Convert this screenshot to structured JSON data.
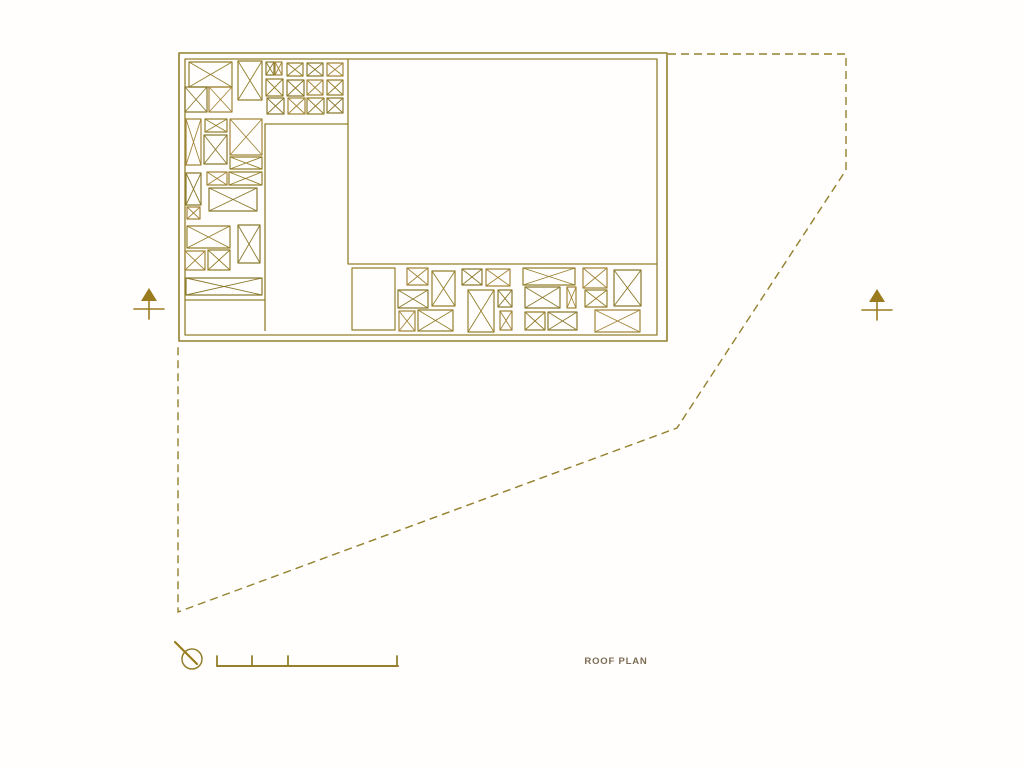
{
  "canvas": {
    "width": 1024,
    "height": 768,
    "background": "#fffefc"
  },
  "title": {
    "label": "ROOF PLAN",
    "color": "#7c6c55"
  },
  "ink": {
    "primary": "#94802d",
    "palette": [
      "#94802d",
      "#8b7a2e",
      "#a3863a"
    ],
    "arrow": "#9a7c1e",
    "dash": "8 5"
  },
  "plan": {
    "outer_wall": [
      179,
      53,
      488,
      288
    ],
    "inner_wall": [
      185,
      59,
      472,
      276
    ],
    "partitions": [
      [
        [
          348,
          59
        ],
        [
          348,
          264
        ],
        [
          657,
          264
        ]
      ],
      [
        [
          348,
          124
        ],
        [
          265,
          124
        ],
        [
          265,
          331
        ]
      ],
      [
        [
          185,
          300
        ],
        [
          265,
          300
        ]
      ]
    ],
    "plain_boxes": [
      [
        352,
        268,
        43,
        62
      ]
    ],
    "crossed_boxes": [
      [
        189,
        62,
        43,
        25
      ],
      [
        185,
        87,
        22,
        25
      ],
      [
        209,
        87,
        23,
        25
      ],
      [
        238,
        61,
        24,
        39
      ],
      [
        266,
        62,
        8,
        13
      ],
      [
        275,
        62,
        7,
        13
      ],
      [
        287,
        63,
        16,
        13
      ],
      [
        307,
        63,
        16,
        13
      ],
      [
        327,
        63,
        16,
        13
      ],
      [
        266,
        79,
        17,
        17
      ],
      [
        287,
        80,
        17,
        16
      ],
      [
        307,
        80,
        16,
        15
      ],
      [
        327,
        80,
        16,
        15
      ],
      [
        267,
        98,
        17,
        16
      ],
      [
        288,
        98,
        17,
        16
      ],
      [
        307,
        98,
        17,
        16
      ],
      [
        327,
        98,
        16,
        15
      ],
      [
        186,
        119,
        15,
        46
      ],
      [
        205,
        119,
        22,
        13
      ],
      [
        204,
        135,
        23,
        29
      ],
      [
        230,
        119,
        32,
        36
      ],
      [
        230,
        157,
        32,
        12
      ],
      [
        186,
        173,
        15,
        32
      ],
      [
        207,
        172,
        20,
        13
      ],
      [
        229,
        172,
        33,
        13
      ],
      [
        209,
        188,
        48,
        23
      ],
      [
        187,
        207,
        13,
        12
      ],
      [
        187,
        226,
        43,
        22
      ],
      [
        238,
        225,
        22,
        38
      ],
      [
        185,
        251,
        20,
        19
      ],
      [
        208,
        250,
        22,
        20
      ],
      [
        186,
        278,
        76,
        17
      ],
      [
        407,
        268,
        21,
        17
      ],
      [
        432,
        271,
        23,
        35
      ],
      [
        398,
        290,
        30,
        18
      ],
      [
        399,
        311,
        16,
        20
      ],
      [
        418,
        310,
        35,
        21
      ],
      [
        462,
        269,
        20,
        16
      ],
      [
        486,
        269,
        24,
        17
      ],
      [
        468,
        290,
        26,
        42
      ],
      [
        498,
        290,
        14,
        17
      ],
      [
        500,
        311,
        12,
        19
      ],
      [
        523,
        268,
        52,
        17
      ],
      [
        525,
        287,
        35,
        21
      ],
      [
        567,
        287,
        9,
        21
      ],
      [
        525,
        312,
        20,
        18
      ],
      [
        548,
        312,
        29,
        18
      ],
      [
        583,
        268,
        24,
        20
      ],
      [
        585,
        290,
        22,
        17
      ],
      [
        614,
        270,
        27,
        36
      ],
      [
        595,
        310,
        45,
        22
      ]
    ]
  },
  "boundary": {
    "points": [
      [
        668,
        54
      ],
      [
        846,
        54
      ],
      [
        846,
        170
      ],
      [
        677,
        428
      ],
      [
        178,
        612
      ],
      [
        178,
        345
      ]
    ]
  },
  "north_arrows": [
    {
      "cx": 149,
      "cy": 305
    },
    {
      "cx": 877,
      "cy": 306
    }
  ],
  "north_indicator": {
    "cx": 192,
    "cy": 659,
    "r": 10,
    "line": [
      [
        197,
        664
      ],
      [
        175,
        642
      ]
    ]
  },
  "scale_bar": {
    "y": 666,
    "x1": 217,
    "x2": 398,
    "ticks": [
      217,
      252,
      288,
      397
    ],
    "tick_h": 10
  }
}
